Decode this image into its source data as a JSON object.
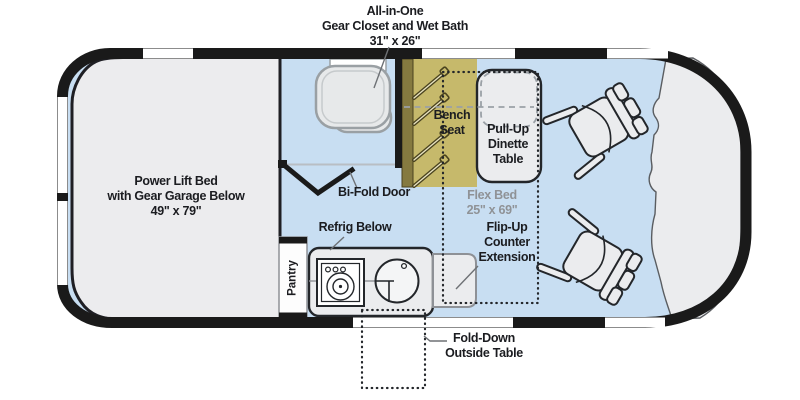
{
  "diagram_type": "rv-camper-van-floorplan",
  "labels": {
    "gear_closet_callout": "All-in-One\nGear Closet and Wet Bath\n31\" x 26\"",
    "power_lift_bed": "Power Lift Bed\nwith Gear Garage Below\n49\" x 79\"",
    "bench_seat": "Bench\nSeat",
    "pull_up_dinette": "Pull-Up\nDinette\nTable",
    "bi_fold_door": "Bi-Fold Door",
    "flex_bed": "Flex Bed\n25\" x 69\"",
    "refrig_below": "Refrig Below",
    "pantry": "Pantry",
    "flip_up_counter": "Flip-Up\nCounter\nExtension",
    "fold_down_outside_table": "Fold-Down\nOutside Table"
  },
  "colors": {
    "floor_blue": "#c8def2",
    "wall_black": "#1a1a1a",
    "furniture_gray": "#ebecee",
    "bench_khaki": "#c6b96b",
    "bench_strip_olive": "#857a40",
    "label_dark": "#1b1c20",
    "label_gray": "#8f9296",
    "toilet_outline": "#9aa0a4",
    "leader_gray": "#6e7175"
  },
  "icons": [
    "toilet-icon",
    "stove-icon",
    "sink-icon",
    "captain-chair-icon",
    "bifold-door-icon",
    "seat-belt-icon",
    "window-segment"
  ]
}
